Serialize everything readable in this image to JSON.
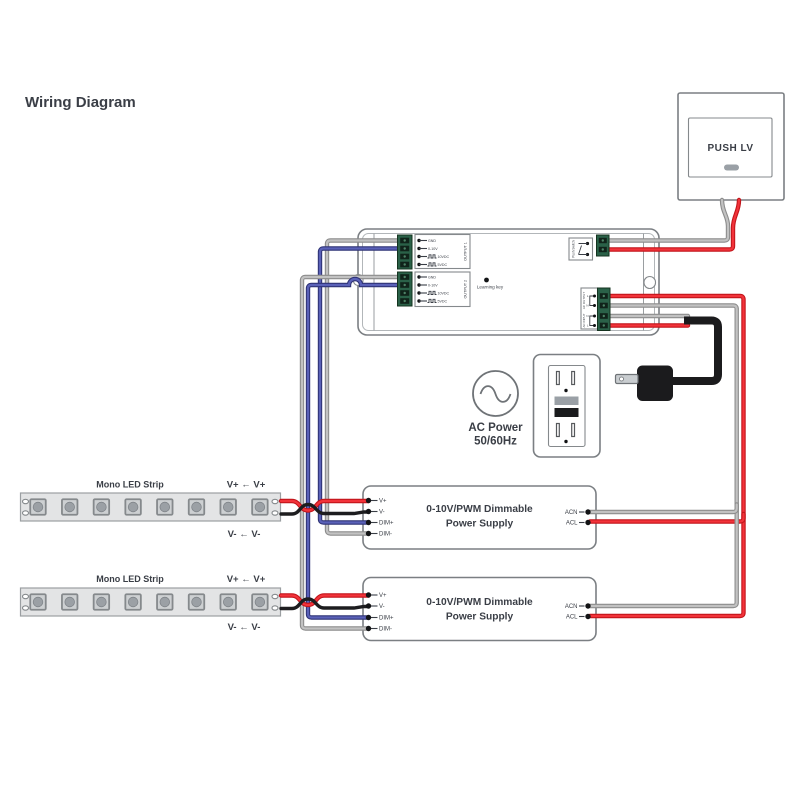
{
  "title": "Wiring Diagram",
  "colors": {
    "wire_red": "#ed1c24",
    "wire_blue": "#4a50a8",
    "wire_gray": "#b9b9b9",
    "wire_black": "#1d1d1f",
    "terminal_green": "#2a6148",
    "outline_gray": "#7b7f83",
    "text_dark": "#3a3e46"
  },
  "push_switch": {
    "label": "PUSH LV"
  },
  "controller": {
    "learning_key_label": "Learning key",
    "output1": {
      "name": "OUTPUT 1",
      "rows": [
        "GND",
        "0-10V",
        "10VDC",
        "5VDC"
      ]
    },
    "output2": {
      "name": "OUTPUT 2",
      "rows": [
        "GND",
        "0-10V",
        "10VDC",
        "5VDC"
      ]
    },
    "push_terminal_label": "Push Switch",
    "ac_terminal": {
      "output_label": "AC OUTPUT",
      "input_label": "AC INPUT",
      "pins": [
        "L",
        "N",
        "N",
        "L"
      ]
    }
  },
  "ac_source": {
    "line1": "AC Power",
    "line2": "50/60Hz"
  },
  "power_supply_1": {
    "title_line1": "0-10V/PWM Dimmable",
    "title_line2": "Power Supply",
    "left_pins": [
      "V+",
      "V-",
      "DIM+",
      "DIM-"
    ],
    "right_pins": [
      "ACN",
      "ACL"
    ]
  },
  "power_supply_2": {
    "title_line1": "0-10V/PWM Dimmable",
    "title_line2": "Power Supply",
    "left_pins": [
      "V+",
      "V-",
      "DIM+",
      "DIM-"
    ],
    "right_pins": [
      "ACN",
      "ACL"
    ]
  },
  "led_strip_1": {
    "label": "Mono LED Strip",
    "top_note": "V+ ← V+",
    "bottom_note": "V- ← V-"
  },
  "led_strip_2": {
    "label": "Mono LED Strip",
    "top_note": "V+ ← V+",
    "bottom_note": "V- ← V-"
  }
}
